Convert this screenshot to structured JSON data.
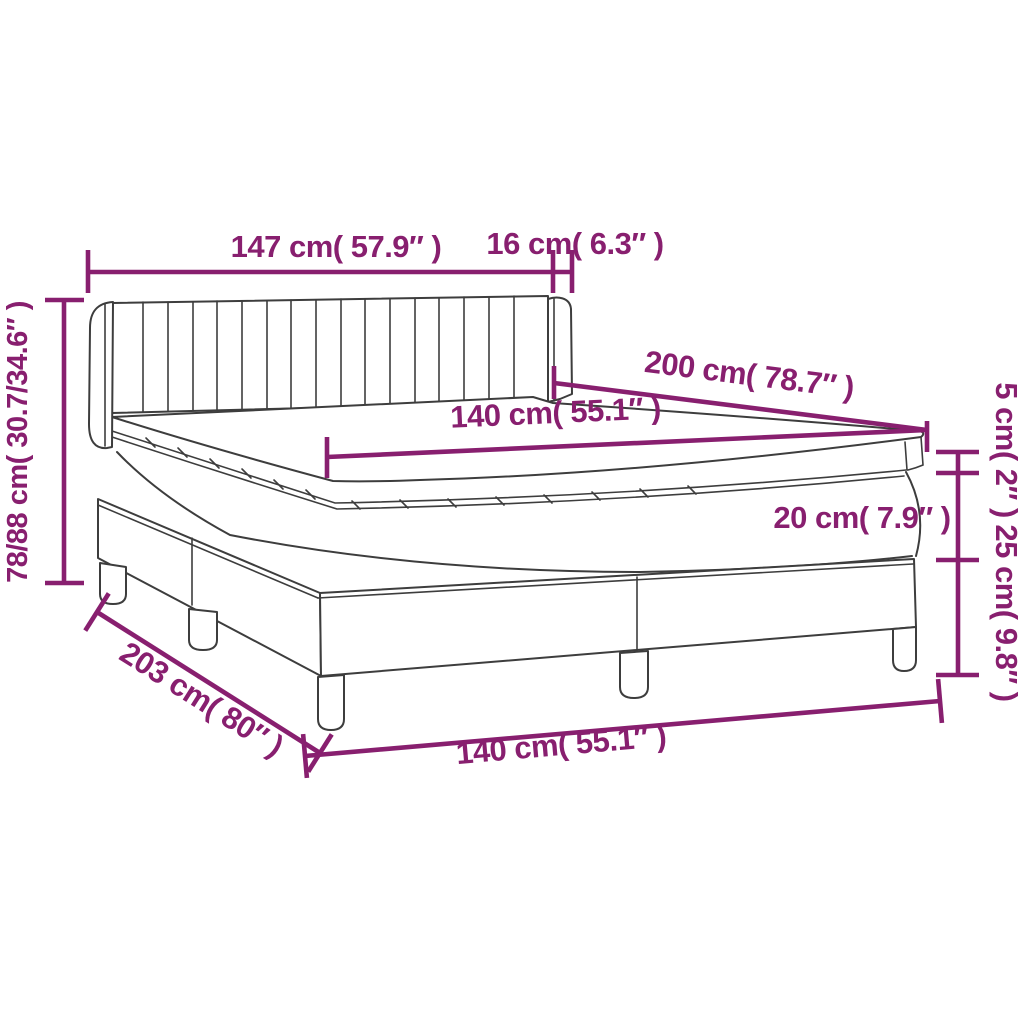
{
  "title": "Box spring bed with mattress dimension diagram",
  "colors": {
    "dimension_accent": "#881f6f",
    "line_art": "#3d3d3d",
    "background": "#ffffff"
  },
  "dimensions": {
    "headboard_width": {
      "label": "147 cm( 57.9″ )"
    },
    "wing_depth": {
      "label": "16 cm( 6.3″ )"
    },
    "height_range": {
      "label": "78/88 cm( 30.7/34.6″ )"
    },
    "frame_length": {
      "label": "203 cm( 80″ )"
    },
    "mattress_length": {
      "label": "200 cm( 78.7″ )"
    },
    "mattress_width": {
      "label": "140 cm( 55.1″ )"
    },
    "base_width": {
      "label": "140 cm( 55.1″ )"
    },
    "topper_thickness": {
      "label": "5 cm( 2″ )"
    },
    "mattress_thickness": {
      "label": "20 cm( 7.9″ )"
    },
    "base_height": {
      "label": "25 cm( 9.8″ )"
    }
  }
}
